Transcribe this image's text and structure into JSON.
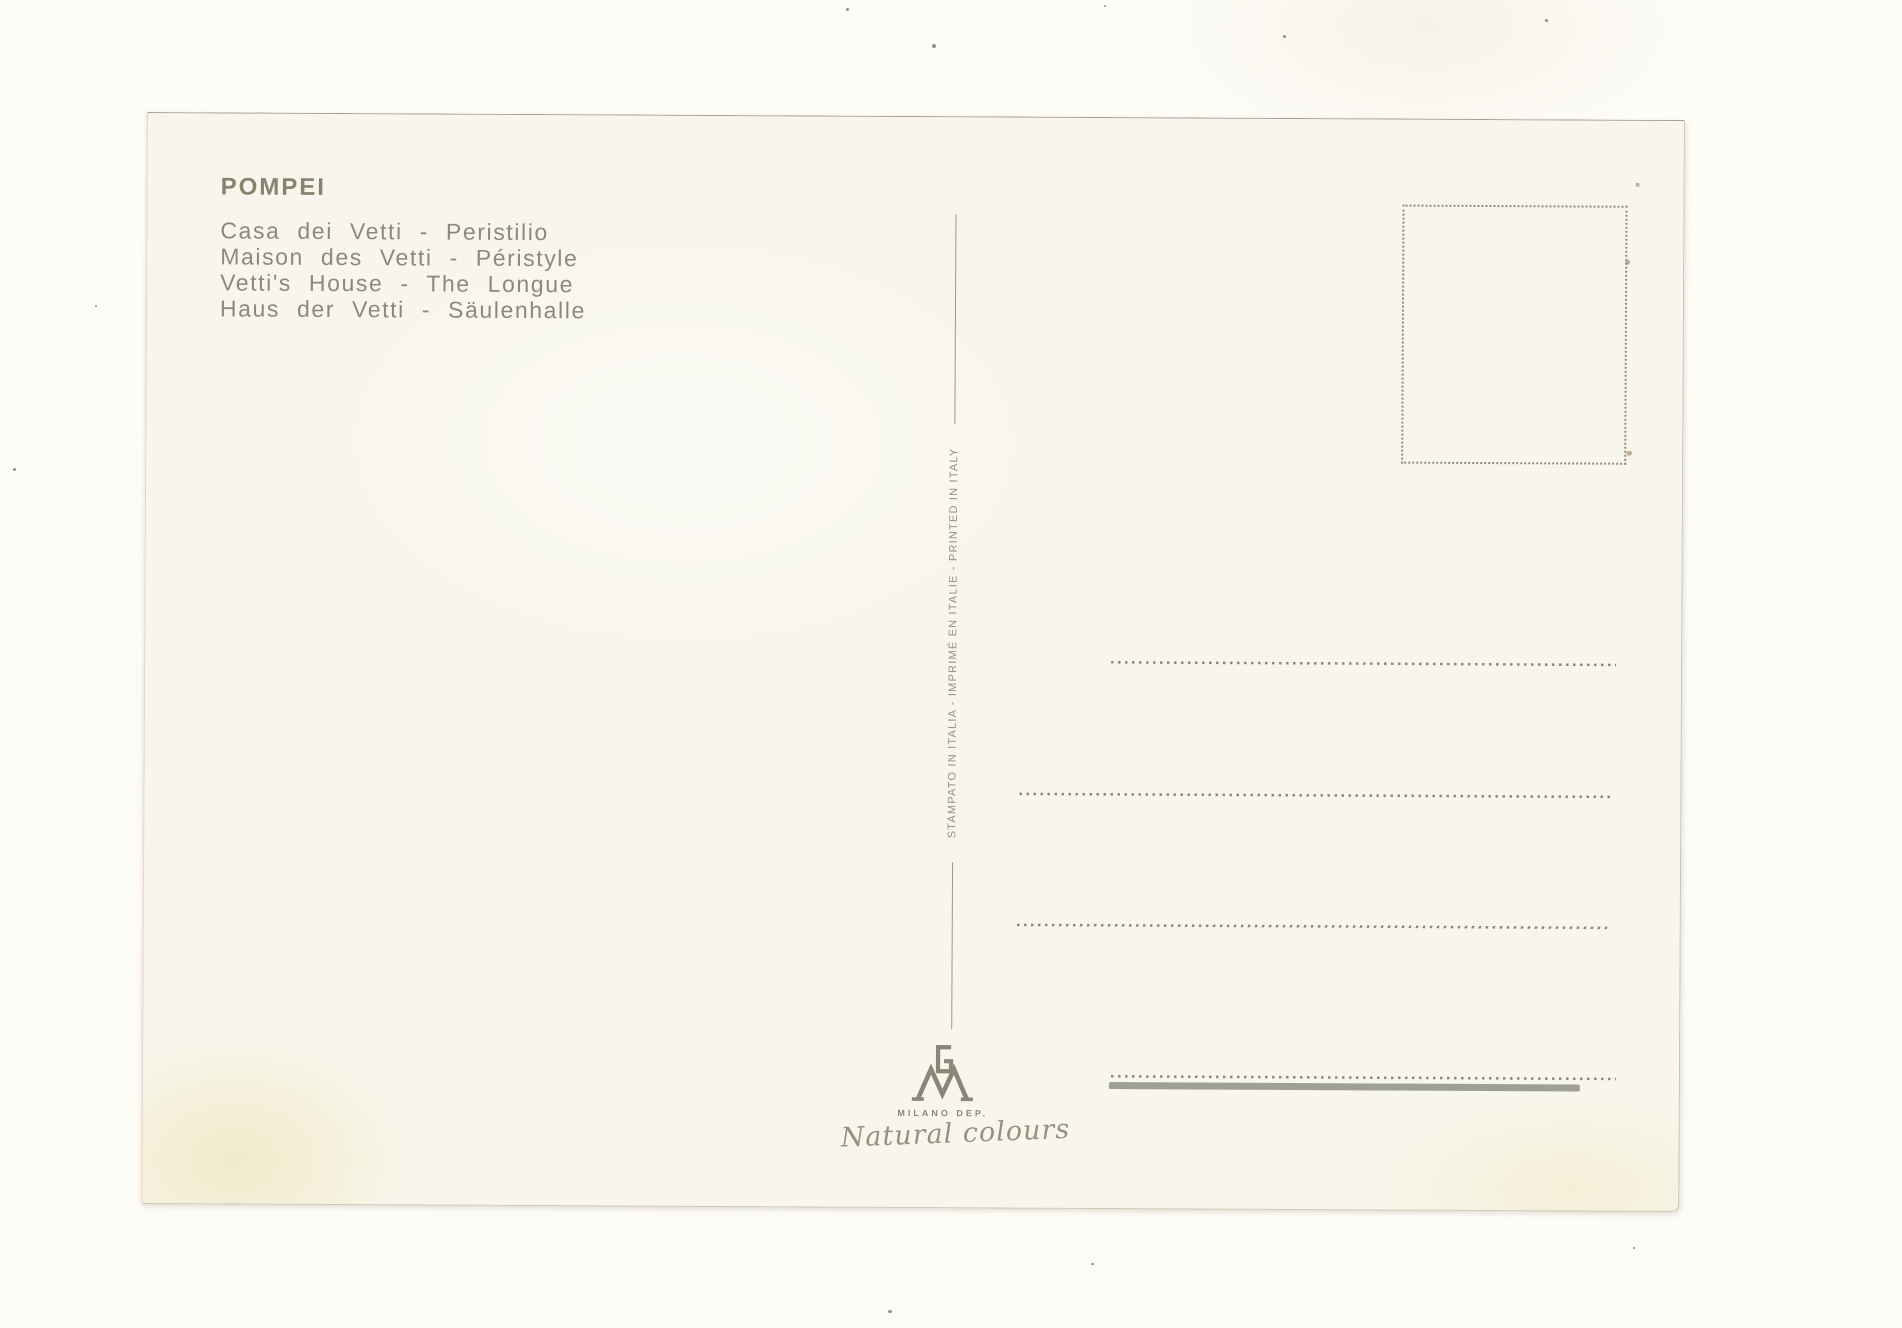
{
  "postcard": {
    "title": "POMPEI",
    "captions": {
      "italian": "Casa dei Vetti - Peristilio",
      "french": "Maison des Vetti - Péristyle",
      "english": "Vetti's House - The Longue",
      "german": "Haus der Vetti - Säulenhalle"
    },
    "divider_text": "STAMPATO IN ITALIA - IMPRIMÉ EN ITALIE - PRINTED IN ITALY",
    "publisher": {
      "monogram": "GM",
      "name": "MILANO DEP.",
      "tagline": "Natural colours"
    },
    "colors": {
      "ink": "#8c897c",
      "card_background": "#f8f6ec",
      "page_background": "#fdfcf8",
      "line": "#8b887a",
      "thick_line": "#8d9084"
    }
  }
}
